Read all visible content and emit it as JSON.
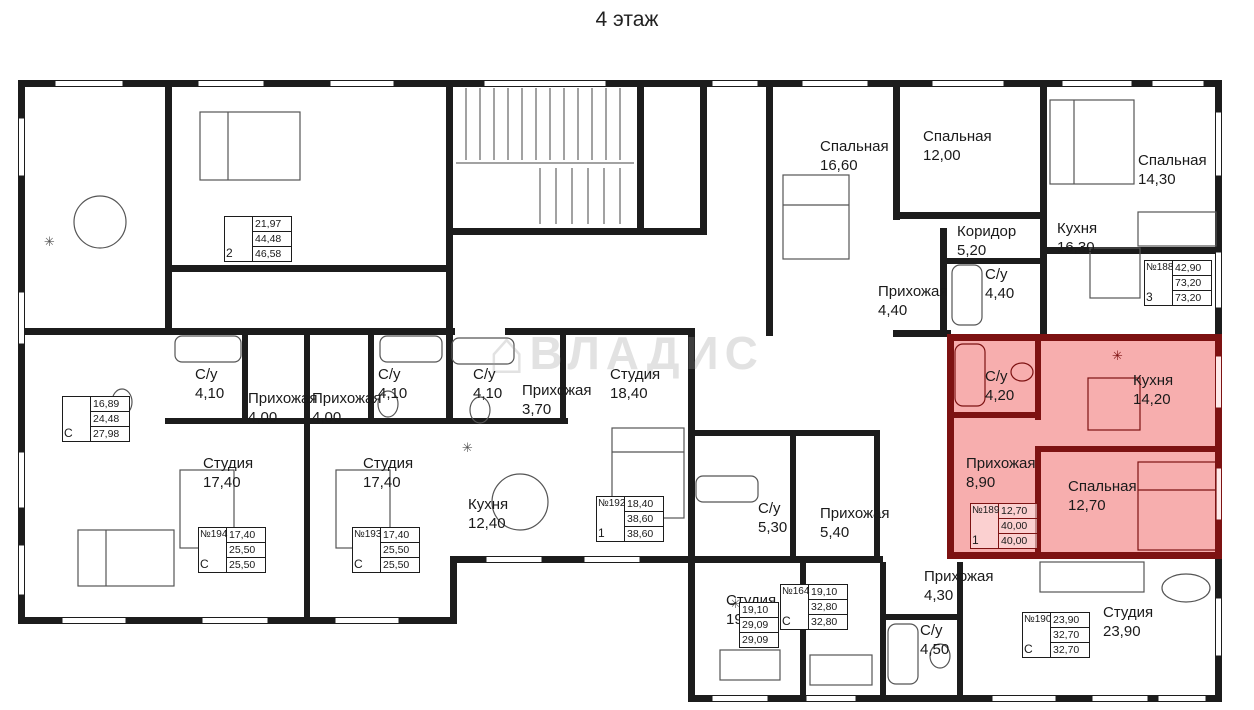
{
  "title": "4 этаж",
  "watermark": "ВЛАДИС",
  "colors": {
    "wall": "#1c1c1c",
    "highlight_fill": "#f6a3a3",
    "highlight_wall": "#7d1212"
  },
  "rooms": [
    {
      "label": "Спальная",
      "area": "16,60"
    },
    {
      "label": "Спальная",
      "area": "12,00"
    },
    {
      "label": "Спальная",
      "area": "14,30"
    },
    {
      "label": "Коридор",
      "area": "5,20"
    },
    {
      "label": "Кухня",
      "area": "16,30"
    },
    {
      "label": "С/у",
      "area": "4,40"
    },
    {
      "label": "Прихожая",
      "area": "4,40"
    },
    {
      "label": "С/у",
      "area": "4,20"
    },
    {
      "label": "Кухня",
      "area": "14,20"
    },
    {
      "label": "Прихожая",
      "area": "8,90"
    },
    {
      "label": "Спальная",
      "area": "12,70"
    },
    {
      "label": "С/у",
      "area": "4,10"
    },
    {
      "label": "Прихожая",
      "area": "4,00"
    },
    {
      "label": "Прихожая",
      "area": "4,00"
    },
    {
      "label": "С/у",
      "area": "4,10"
    },
    {
      "label": "Студия",
      "area": "17,40"
    },
    {
      "label": "Студия",
      "area": "17,40"
    },
    {
      "label": "С/у",
      "area": "4,10"
    },
    {
      "label": "Прихожая",
      "area": "3,70"
    },
    {
      "label": "Студия",
      "area": "18,40"
    },
    {
      "label": "Кухня",
      "area": "12,40"
    },
    {
      "label": "С/у",
      "area": "5,30"
    },
    {
      "label": "Прихожая",
      "area": "5,40"
    },
    {
      "label": "Студия",
      "area": "19,10"
    },
    {
      "label": "Прихожая",
      "area": "4,30"
    },
    {
      "label": "С/у",
      "area": "4,50"
    },
    {
      "label": "Студия",
      "area": "23,90"
    }
  ],
  "units": [
    {
      "num": "",
      "type": "2",
      "values": [
        "21,97",
        "44,48",
        "46,58"
      ]
    },
    {
      "num": "",
      "type": "С",
      "values": [
        "16,89",
        "24,48",
        "27,98"
      ]
    },
    {
      "num": "№188",
      "type": "3",
      "values": [
        "42,90",
        "73,20",
        "73,20"
      ]
    },
    {
      "num": "№189",
      "type": "1",
      "values": [
        "12,70",
        "40,00",
        "40,00"
      ]
    },
    {
      "num": "№192",
      "type": "1",
      "values": [
        "18,40",
        "38,60",
        "38,60"
      ]
    },
    {
      "num": "№194",
      "type": "С",
      "values": [
        "17,40",
        "25,50",
        "25,50"
      ]
    },
    {
      "num": "№193",
      "type": "С",
      "values": [
        "17,40",
        "25,50",
        "25,50"
      ]
    },
    {
      "num": "№164",
      "type": "С",
      "values": [
        "19,10",
        "32,80",
        "32,80"
      ]
    },
    {
      "num": "№190",
      "type": "С",
      "values": [
        "23,90",
        "32,70",
        "32,70"
      ]
    },
    {
      "num": "",
      "type": "",
      "values": [
        "19,10",
        "29,09",
        "29,09"
      ]
    }
  ]
}
